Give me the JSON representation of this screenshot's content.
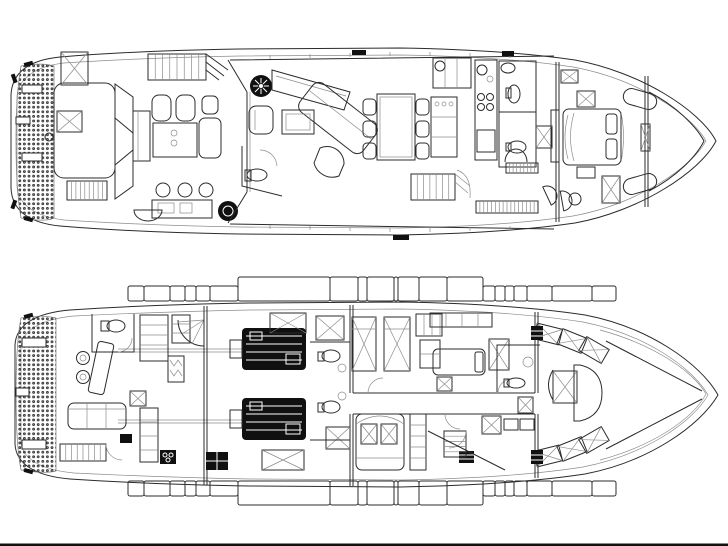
{
  "document": {
    "type": "yacht-deck-floorplan",
    "views": [
      {
        "id": "main-deck",
        "position": "top"
      },
      {
        "id": "lower-deck",
        "position": "bottom"
      }
    ]
  },
  "colors": {
    "background": "#fbfbfb",
    "paper": "#ffffff",
    "line": "#2b2b2b",
    "line_light": "#8c8c8c",
    "black_fill": "#101010",
    "band_black": "#0c0c0c",
    "band_outline": "#9a9a9a",
    "teak_dot": "#6f6f6f",
    "bottom_rule": "#3f3f3f"
  },
  "main_deck": {
    "features": [
      "swim-platform-teak",
      "transom-hatches",
      "aft-deck-sunpad-hatches",
      "aft-deck-stairs",
      "aft-dinette-chairs",
      "aft-dinette-table",
      "aft-l-bench",
      "bar-stools",
      "wet-bar-counter",
      "round-grill",
      "curved-bench",
      "flybridge-stairs",
      "salon-entry-door",
      "spiral-stair",
      "salon-corner-sofa",
      "armchair",
      "coffee-table",
      "curved-chair",
      "angled-cabinet",
      "day-head-toilet",
      "dining-table",
      "dining-chairs",
      "sideboard",
      "galley-counter",
      "galley-island-stove",
      "guest-head",
      "shower",
      "stairs-to-lower-deck",
      "side-deck-grates",
      "master-bed",
      "nightstand",
      "skylight-hatch",
      "tv-cabinet",
      "vanity-stools",
      "bow-seating"
    ]
  },
  "lower_deck": {
    "features": [
      "swim-platform-teak",
      "crew-sofa",
      "crew-tv",
      "crew-galley-counter",
      "stove-burners",
      "crew-head",
      "crew-lockers",
      "hanging-wardrobe",
      "drawer-column",
      "crew-stove",
      "aft-stairs",
      "spiral-stairs",
      "step-hatch",
      "engine-room",
      "port-engine",
      "starboard-engine",
      "propeller-shafts",
      "ventilation-hatches",
      "bilge-pump",
      "en-suite-toilets",
      "twin-bed-cabin",
      "double-bed-cabin",
      "forward-guest-bed",
      "wardrobes",
      "corridor",
      "companionway-stairs",
      "mid-bathroom",
      "vip-dinette-table",
      "vip-bench-seating",
      "vip-angled-berths",
      "bow-void"
    ]
  },
  "window_bands": {
    "upper": {
      "x": 128,
      "base": 301,
      "thin": 15,
      "tall": 24,
      "segments": [
        {
          "w": 16,
          "c": "black"
        },
        {
          "w": 26,
          "c": "white"
        },
        {
          "w": 15,
          "c": "black"
        },
        {
          "w": 11,
          "c": "white"
        },
        {
          "w": 14,
          "c": "black"
        },
        {
          "w": 28,
          "c": "white"
        },
        {
          "w": 92,
          "c": "black",
          "tall": true
        },
        {
          "w": 28,
          "c": "white",
          "tall": true
        },
        {
          "w": 9,
          "c": "black",
          "tall": true
        },
        {
          "w": 27,
          "c": "white",
          "tall": true
        },
        {
          "w": 4,
          "c": "black",
          "tall": true
        },
        {
          "w": 21,
          "c": "white",
          "tall": true
        },
        {
          "w": 28,
          "c": "black",
          "tall": true
        },
        {
          "w": 36,
          "c": "white",
          "tall": true
        },
        {
          "w": 12,
          "c": "black"
        },
        {
          "w": 10,
          "c": "white"
        },
        {
          "w": 9,
          "c": "black"
        },
        {
          "w": 13,
          "c": "white"
        },
        {
          "w": 25,
          "c": "black"
        },
        {
          "w": 40,
          "c": "white"
        },
        {
          "w": 24,
          "c": "black"
        }
      ]
    },
    "lower": {
      "x": 128,
      "base": 481,
      "thin": 15,
      "tall": 24,
      "segments": [
        {
          "w": 16,
          "c": "black"
        },
        {
          "w": 26,
          "c": "white"
        },
        {
          "w": 15,
          "c": "black"
        },
        {
          "w": 11,
          "c": "white"
        },
        {
          "w": 14,
          "c": "black"
        },
        {
          "w": 28,
          "c": "white"
        },
        {
          "w": 92,
          "c": "black",
          "tall": true
        },
        {
          "w": 28,
          "c": "white",
          "tall": true
        },
        {
          "w": 9,
          "c": "black",
          "tall": true
        },
        {
          "w": 27,
          "c": "white",
          "tall": true
        },
        {
          "w": 4,
          "c": "black",
          "tall": true
        },
        {
          "w": 21,
          "c": "white",
          "tall": true
        },
        {
          "w": 28,
          "c": "black",
          "tall": true
        },
        {
          "w": 36,
          "c": "white",
          "tall": true
        },
        {
          "w": 12,
          "c": "black"
        },
        {
          "w": 10,
          "c": "white"
        },
        {
          "w": 9,
          "c": "black"
        },
        {
          "w": 13,
          "c": "white"
        },
        {
          "w": 25,
          "c": "black"
        },
        {
          "w": 40,
          "c": "white"
        },
        {
          "w": 24,
          "c": "black"
        }
      ]
    }
  }
}
